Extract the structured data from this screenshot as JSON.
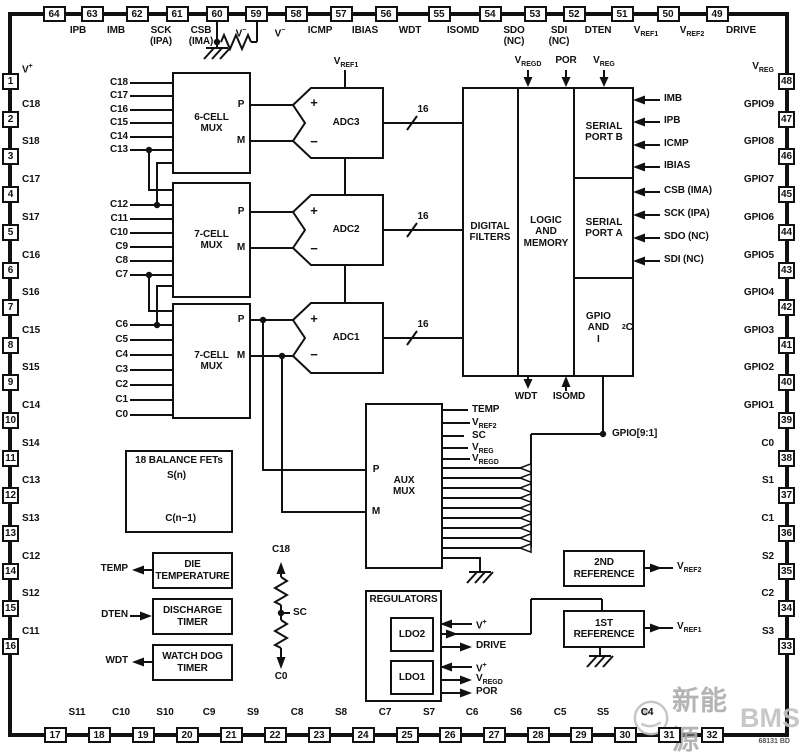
{
  "pins": {
    "top": [
      {
        "num": "64",
        "label": "IPB"
      },
      {
        "num": "63",
        "label": "IMB"
      },
      {
        "num": "62",
        "label": "SCK|(IPA)"
      },
      {
        "num": "61",
        "label": "CSB|(IMA)"
      },
      {
        "num": "60",
        "label": "V^{−}"
      },
      {
        "num": "59",
        "label": "V^{−}"
      },
      {
        "num": "58",
        "label": "ICMP"
      },
      {
        "num": "57",
        "label": "IBIAS"
      },
      {
        "num": "56",
        "label": "WDT"
      },
      {
        "num": "55",
        "label": "ISOMD"
      },
      {
        "num": "54",
        "label": "SDO|(NC)"
      },
      {
        "num": "53",
        "label": "SDI|(NC)"
      },
      {
        "num": "52",
        "label": "DTEN"
      },
      {
        "num": "51",
        "label": "V_{REF1}"
      },
      {
        "num": "50",
        "label": "V_{REF2}"
      },
      {
        "num": "49",
        "label": "DRIVE"
      }
    ],
    "left": [
      {
        "num": "1",
        "label": "V^{+}"
      },
      {
        "num": "2",
        "label": "C18"
      },
      {
        "num": "3",
        "label": "S18"
      },
      {
        "num": "4",
        "label": "C17"
      },
      {
        "num": "5",
        "label": "S17"
      },
      {
        "num": "6",
        "label": "C16"
      },
      {
        "num": "7",
        "label": "S16"
      },
      {
        "num": "8",
        "label": "C15"
      },
      {
        "num": "9",
        "label": "S15"
      },
      {
        "num": "10",
        "label": "C14"
      },
      {
        "num": "11",
        "label": "S14"
      },
      {
        "num": "12",
        "label": "C13"
      },
      {
        "num": "13",
        "label": "S13"
      },
      {
        "num": "14",
        "label": "C12"
      },
      {
        "num": "15",
        "label": "S12"
      },
      {
        "num": "16",
        "label": "C11"
      }
    ],
    "right": [
      {
        "num": "48",
        "label": "V_{REG}"
      },
      {
        "num": "47",
        "label": "GPIO9"
      },
      {
        "num": "46",
        "label": "GPIO8"
      },
      {
        "num": "45",
        "label": "GPIO7"
      },
      {
        "num": "44",
        "label": "GPIO6"
      },
      {
        "num": "43",
        "label": "GPIO5"
      },
      {
        "num": "42",
        "label": "GPIO4"
      },
      {
        "num": "41",
        "label": "GPIO3"
      },
      {
        "num": "40",
        "label": "GPIO2"
      },
      {
        "num": "39",
        "label": "GPIO1"
      },
      {
        "num": "38",
        "label": "C0"
      },
      {
        "num": "37",
        "label": "S1"
      },
      {
        "num": "36",
        "label": "C1"
      },
      {
        "num": "35",
        "label": "S2"
      },
      {
        "num": "34",
        "label": "C2"
      },
      {
        "num": "33",
        "label": "S3"
      }
    ],
    "bottom": [
      {
        "num": "17",
        "label": "S11"
      },
      {
        "num": "18",
        "label": "C10"
      },
      {
        "num": "19",
        "label": "S10"
      },
      {
        "num": "20",
        "label": "C9"
      },
      {
        "num": "21",
        "label": "S9"
      },
      {
        "num": "22",
        "label": "C8"
      },
      {
        "num": "23",
        "label": "S8"
      },
      {
        "num": "24",
        "label": "C7"
      },
      {
        "num": "25",
        "label": "S7"
      },
      {
        "num": "26",
        "label": "C6"
      },
      {
        "num": "27",
        "label": "S6"
      },
      {
        "num": "28",
        "label": "C5"
      },
      {
        "num": "29",
        "label": "S5"
      },
      {
        "num": "30",
        "label": "C4"
      },
      {
        "num": "31",
        "label": ""
      },
      {
        "num": "32",
        "label": ""
      }
    ]
  },
  "blocks": {
    "mux1": "6-CELL|MUX",
    "mux2": "7-CELL|MUX",
    "mux3": "7-CELL|MUX",
    "adc3": "ADC3",
    "adc2": "ADC2",
    "adc1": "ADC1",
    "digital_filters": "DIGITAL|FILTERS",
    "logic": "LOGIC|AND|MEMORY",
    "port_b": "SERIAL|PORT B",
    "port_a": "SERIAL|PORT A",
    "gpio_i2c": "GPIO AND|I^{2}C",
    "aux_mux": "AUX|MUX",
    "balance": "18 BALANCE FETs",
    "die_temp": "DIE|TEMPERATURE",
    "discharge": "DISCHARGE|TIMER",
    "watchdog": "WATCH DOG|TIMER",
    "regulators": "REGULATORS",
    "ldo2": "LDO2",
    "ldo1": "LDO1",
    "ref2": "2ND|REFERENCE",
    "ref1": "1ST|REFERENCE"
  },
  "signals": {
    "vref1_top": "V_{REF1}",
    "logic_top": [
      "V_{REGD}",
      "POR",
      "V_{REG}"
    ],
    "logic_bottom": [
      "WDT",
      "ISOMD"
    ],
    "port_b_in": [
      "IMB",
      "IPB",
      "ICMP",
      "IBIAS"
    ],
    "port_a_in": [
      "CSB (IMA)",
      "SCK (IPA)",
      "SDO (NC)",
      "SDI (NC)"
    ],
    "gpio_bus": "GPIO[9:1]",
    "mux1_in": [
      "C18",
      "C17",
      "C16",
      "C15",
      "C14",
      "C13"
    ],
    "mux2_in": [
      "C12",
      "C11",
      "C10",
      "C9",
      "C8",
      "C7"
    ],
    "mux3_in": [
      "C6",
      "C5",
      "C4",
      "C3",
      "C2",
      "C1",
      "C0"
    ],
    "aux_in": [
      "TEMP",
      "V_{REF2}",
      "SC",
      "V_{REG}",
      "V_{REGD}"
    ],
    "adc_bus_width": "16",
    "p": "P",
    "m": "M",
    "plus": "+",
    "minus": "−",
    "fet_s": "S(n)",
    "fet_c": "C(n−1)",
    "left_io": [
      "TEMP",
      "DTEN",
      "WDT"
    ],
    "res_chain": [
      "C18",
      "SC",
      "C0"
    ],
    "reg_io": [
      "V^{+}",
      "DRIVE",
      "V^{+}",
      "V_{REGD}",
      "POR"
    ],
    "ref2_out": "V_{REF2}",
    "ref1_out": "V_{REF1}"
  },
  "footer": {
    "figure_code": "68131 BD"
  },
  "watermark": {
    "cn": "新能源",
    "en": "BMS"
  }
}
